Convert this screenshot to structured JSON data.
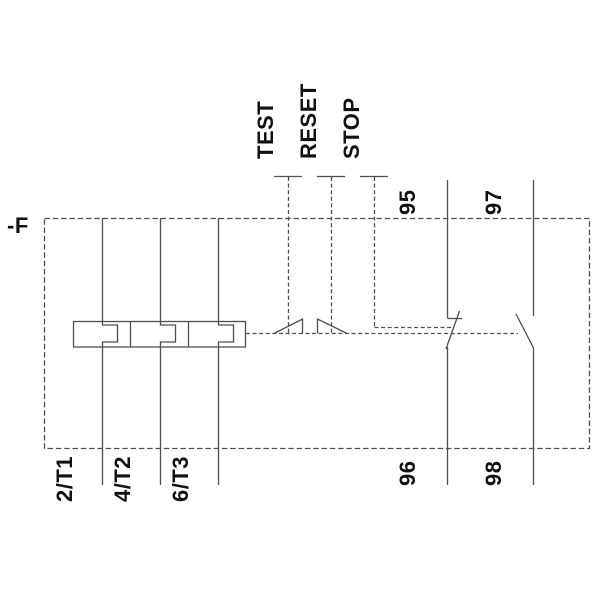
{
  "diagram": {
    "device_label": "-F",
    "buttons": [
      {
        "label": "TEST"
      },
      {
        "label": "RESET"
      },
      {
        "label": "STOP"
      }
    ],
    "contacts": [
      {
        "type": "NC",
        "top_terminal": "95",
        "bottom_terminal": "96"
      },
      {
        "type": "NO",
        "top_terminal": "97",
        "bottom_terminal": "98"
      }
    ],
    "load_terminals": [
      {
        "label": "2/T1"
      },
      {
        "label": "4/T2"
      },
      {
        "label": "6/T3"
      }
    ],
    "colors": {
      "line": "#4f4f4f",
      "text": "#111111",
      "background": "#ffffff"
    }
  }
}
